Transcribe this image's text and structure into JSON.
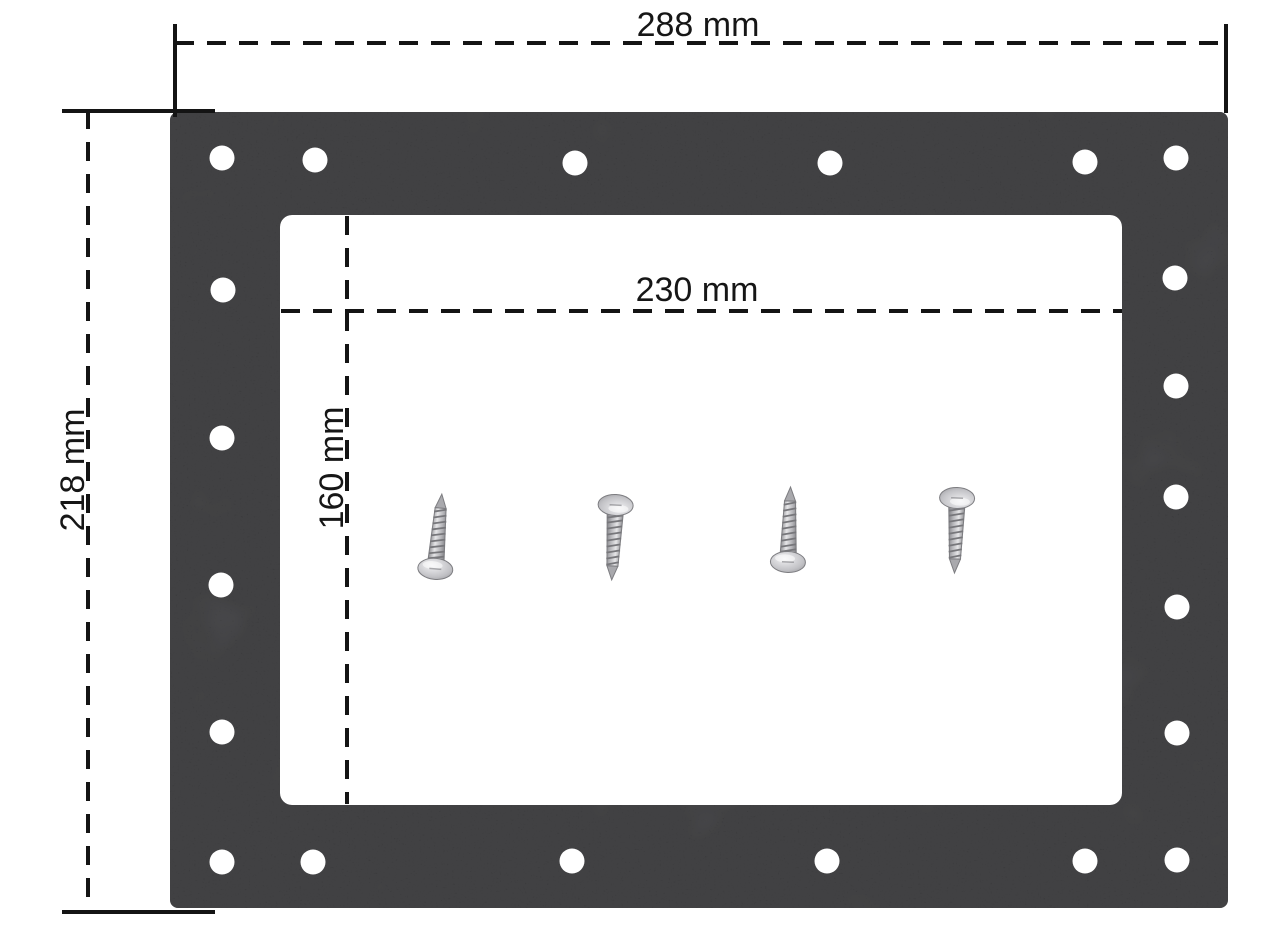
{
  "diagram": {
    "background_color": "#ffffff",
    "gasket": {
      "semantic": "rectangular-gasket-with-bolt-holes",
      "color": "#414144",
      "hole_color": "#ffffff",
      "hole_count": 21
    },
    "dimension_labels": {
      "outer_width": "288 mm",
      "outer_height": "218 mm",
      "inner_width": "230 mm",
      "inner_height": "160 mm"
    },
    "screws": {
      "count": 4,
      "metal_color": "#b9b9bd"
    },
    "line_color": "#141414"
  }
}
